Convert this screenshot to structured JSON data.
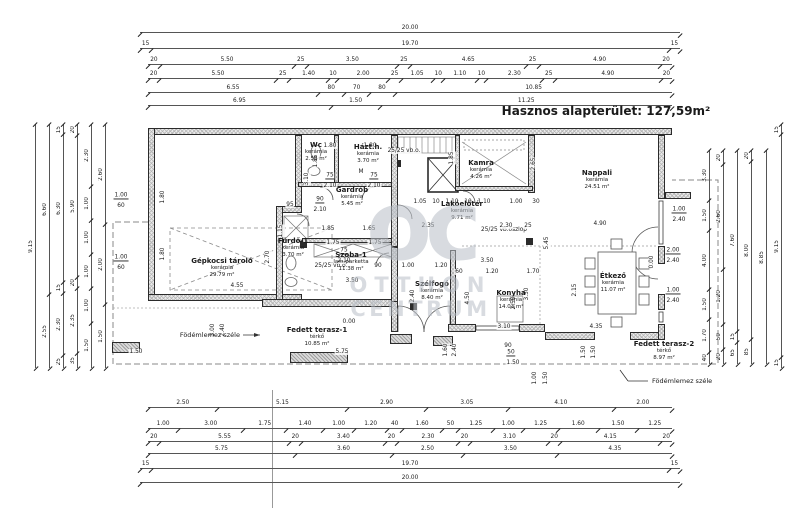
{
  "title": "Hasznos alapterület: 127,59m²",
  "watermark": {
    "logo": "oc",
    "line1": "OTTHON",
    "line2": "CENTRUM"
  },
  "slab_edge_label_left": "Födémlemez széle",
  "slab_edge_label_right": "Födémlemez széle",
  "rooms": [
    {
      "name": "Gépkocsi tároló",
      "material": "kerámia",
      "area": "29.79 m²"
    },
    {
      "name": "Wc",
      "material": "kerámia",
      "area": "2.58 m²"
    },
    {
      "name": "Házt.h.",
      "material": "kerámia",
      "area": "3.70 m²"
    },
    {
      "name": "Gardrób",
      "material": "kerámia",
      "area": "5.45 m²"
    },
    {
      "name": "Kamra",
      "material": "kerámia",
      "area": "4.26 m²"
    },
    {
      "name": "Nappali",
      "material": "kerámia",
      "area": "24.51 m²"
    },
    {
      "name": "Lakóelőtér",
      "material": "kerámia",
      "area": "9.71 m²"
    },
    {
      "name": "Fürdő-1",
      "material": "kerámia",
      "area": "3.70 m²"
    },
    {
      "name": "Szoba-1",
      "material": "lam.parketta",
      "area": "11.38 m²"
    },
    {
      "name": "Szélfogó",
      "material": "kerámia",
      "area": "8.40 m²"
    },
    {
      "name": "Konyha",
      "material": "kerámia",
      "area": "14.03 m²"
    },
    {
      "name": "Étkező",
      "material": "kerámia",
      "area": "11.07 m²"
    },
    {
      "name": "Fedett terasz-1",
      "material": "térkő",
      "area": "10.85 m²"
    },
    {
      "name": "Fedett terasz-2",
      "material": "térkő",
      "area": "8.97 m²"
    }
  ],
  "dims": {
    "top": [
      [
        "20.00"
      ],
      [
        "15",
        "19.70",
        "15"
      ],
      [
        "20",
        "5.50",
        "25",
        "3.50",
        "25",
        "4.65",
        "25",
        "4.90",
        "20"
      ],
      [
        "20",
        "5.50",
        "25",
        "1.40",
        "10",
        "2.00",
        "25",
        "1.05",
        "10",
        "1.10",
        "10",
        "2.30",
        "25",
        "4.90",
        "20"
      ],
      [
        "6.55",
        "80",
        "70",
        "80",
        "10.85"
      ],
      [
        "6.95",
        "1.50",
        "11.25"
      ]
    ],
    "bottom": [
      [
        "2.50",
        "5.15",
        "2.90",
        "3.05",
        "4.10",
        "2.00"
      ],
      [
        "1.00",
        "3.00",
        "1.75",
        "1.40",
        "1.00",
        "1.20",
        "40",
        "1.60",
        "50",
        "1.25",
        "1.00",
        "1.25",
        "1.60",
        "1.50",
        "1.25"
      ],
      [
        "20",
        "5.55",
        "20",
        "3.40",
        "20",
        "2.30",
        "20",
        "3.10",
        "20",
        "4.15",
        "20"
      ],
      [
        "5.75",
        "3.60",
        "2.50",
        "3.50",
        "4.35"
      ],
      [
        "15",
        "19.70",
        "15"
      ],
      [
        "20.00"
      ]
    ],
    "left": [
      [
        "9.15"
      ],
      [
        "6.60",
        "2.55"
      ],
      [
        "15",
        "6.30",
        "15",
        "2.30",
        "25"
      ],
      [
        "20",
        "5.90",
        "20",
        "2.35",
        "35"
      ],
      [
        "2.30",
        "1.00",
        "1.00",
        "1.00",
        "1.00",
        "1.50"
      ],
      [
        "2.60",
        "2.00",
        "1.50"
      ]
    ],
    "right": [
      [
        "3.30",
        "1.50",
        "4.00",
        "1.50",
        "1.70",
        "40"
      ],
      [
        "20",
        "2.60",
        "1.20",
        "50",
        "20"
      ],
      [
        "7.60",
        "15",
        "65"
      ],
      [
        "20",
        "8.00",
        "85"
      ],
      [
        "8.85"
      ],
      [
        "15",
        "9.15",
        "15"
      ]
    ]
  },
  "annotations": [
    {
      "t": "25/25 vb.o.",
      "x": 404,
      "y": 151
    },
    {
      "t": "25/25 vb.o.",
      "x": 331,
      "y": 266
    },
    {
      "t": "25/25 vb.oszlop",
      "x": 504,
      "y": 230
    },
    {
      "t": "0.00",
      "x": 349,
      "y": 322
    },
    {
      "t": "0.00",
      "x": 652,
      "y": 262,
      "v": 1
    },
    {
      "t": "1.00",
      "x": 679,
      "y": 210,
      "u": 1
    },
    {
      "t": "2.40",
      "x": 679,
      "y": 220
    },
    {
      "t": "2.00",
      "x": 673,
      "y": 251,
      "u": 1
    },
    {
      "t": "2.40",
      "x": 673,
      "y": 261
    },
    {
      "t": "1.00",
      "x": 673,
      "y": 291,
      "u": 1
    },
    {
      "t": "2.40",
      "x": 673,
      "y": 301
    },
    {
      "t": "1.00",
      "x": 121,
      "y": 196,
      "u": 1
    },
    {
      "t": "60",
      "x": 121,
      "y": 206
    },
    {
      "t": "1.00",
      "x": 121,
      "y": 258,
      "u": 1
    },
    {
      "t": "60",
      "x": 121,
      "y": 268
    },
    {
      "t": "1.80",
      "x": 163,
      "y": 197,
      "v": 1
    },
    {
      "t": "1.80",
      "x": 163,
      "y": 254,
      "v": 1
    },
    {
      "t": "4.55",
      "x": 237,
      "y": 286
    },
    {
      "t": "2.70",
      "x": 268,
      "y": 257,
      "v": 1
    },
    {
      "t": "3.10",
      "x": 307,
      "y": 179,
      "v": 1
    },
    {
      "t": "1.85",
      "x": 316,
      "y": 161,
      "v": 1
    },
    {
      "t": "1.15",
      "x": 281,
      "y": 231,
      "v": 1
    },
    {
      "t": "1.80",
      "x": 330,
      "y": 146
    },
    {
      "t": "1.80",
      "x": 370,
      "y": 146
    },
    {
      "t": "M",
      "x": 361,
      "y": 172
    },
    {
      "t": "75",
      "x": 330,
      "y": 176,
      "u": 1
    },
    {
      "t": "2.10",
      "x": 330,
      "y": 186
    },
    {
      "t": "75",
      "x": 374,
      "y": 176,
      "u": 1
    },
    {
      "t": "2.10",
      "x": 374,
      "y": 186
    },
    {
      "t": "90",
      "x": 320,
      "y": 200,
      "u": 1
    },
    {
      "t": "2.10",
      "x": 320,
      "y": 210
    },
    {
      "t": "95",
      "x": 290,
      "y": 205
    },
    {
      "t": "75",
      "x": 344,
      "y": 251,
      "u": 1
    },
    {
      "t": "2.10",
      "x": 344,
      "y": 261
    },
    {
      "t": "1.85",
      "x": 328,
      "y": 229
    },
    {
      "t": "1.65",
      "x": 369,
      "y": 229
    },
    {
      "t": "1.75",
      "x": 333,
      "y": 243
    },
    {
      "t": "1.75",
      "x": 375,
      "y": 243
    },
    {
      "t": "3.50",
      "x": 352,
      "y": 281
    },
    {
      "t": "1.05",
      "x": 420,
      "y": 202
    },
    {
      "t": "10",
      "x": 436,
      "y": 202
    },
    {
      "t": "1.10",
      "x": 452,
      "y": 202
    },
    {
      "t": "10",
      "x": 468,
      "y": 202
    },
    {
      "t": "1.10",
      "x": 484,
      "y": 202
    },
    {
      "t": "1.00",
      "x": 516,
      "y": 202
    },
    {
      "t": "30",
      "x": 536,
      "y": 202
    },
    {
      "t": "2.35",
      "x": 428,
      "y": 226
    },
    {
      "t": "2.30",
      "x": 506,
      "y": 226
    },
    {
      "t": "25",
      "x": 528,
      "y": 226
    },
    {
      "t": "4.90",
      "x": 600,
      "y": 224
    },
    {
      "t": "1.85",
      "x": 452,
      "y": 158,
      "v": 1
    },
    {
      "t": "2.65",
      "x": 534,
      "y": 164,
      "v": 1
    },
    {
      "t": "5.45",
      "x": 547,
      "y": 243,
      "v": 1
    },
    {
      "t": "2.15",
      "x": 575,
      "y": 290,
      "v": 1
    },
    {
      "t": "90",
      "x": 378,
      "y": 266
    },
    {
      "t": "1.00",
      "x": 408,
      "y": 266
    },
    {
      "t": "1.20",
      "x": 441,
      "y": 266
    },
    {
      "t": "2.40",
      "x": 413,
      "y": 296,
      "v": 1
    },
    {
      "t": "3.50",
      "x": 487,
      "y": 261
    },
    {
      "t": "60",
      "x": 459,
      "y": 272
    },
    {
      "t": "1.20",
      "x": 492,
      "y": 272
    },
    {
      "t": "1.70",
      "x": 533,
      "y": 272
    },
    {
      "t": "4.50",
      "x": 468,
      "y": 298,
      "v": 1
    },
    {
      "t": "3.50",
      "x": 527,
      "y": 294,
      "v": 1
    },
    {
      "t": "2.50",
      "x": 514,
      "y": 303,
      "v": 1
    },
    {
      "t": "3.10",
      "x": 504,
      "y": 327
    },
    {
      "t": "4.35",
      "x": 596,
      "y": 327
    },
    {
      "t": "90",
      "x": 508,
      "y": 346
    },
    {
      "t": "50",
      "x": 511,
      "y": 353,
      "u": 1
    },
    {
      "t": "1.50",
      "x": 513,
      "y": 363
    },
    {
      "t": "1.00",
      "x": 535,
      "y": 378,
      "v": 1
    },
    {
      "t": "1.50",
      "x": 546,
      "y": 378,
      "v": 1
    },
    {
      "t": "1.50",
      "x": 584,
      "y": 352,
      "v": 1
    },
    {
      "t": "1.50",
      "x": 594,
      "y": 352,
      "v": 1
    },
    {
      "t": "3.00",
      "x": 213,
      "y": 330,
      "v": 1
    },
    {
      "t": "2.40",
      "x": 223,
      "y": 330,
      "v": 1
    },
    {
      "t": "1.50",
      "x": 136,
      "y": 352
    },
    {
      "t": "5.75",
      "x": 342,
      "y": 352
    },
    {
      "t": "2.40",
      "x": 455,
      "y": 350,
      "v": 1
    },
    {
      "t": "1.60",
      "x": 446,
      "y": 350,
      "v": 1
    }
  ]
}
